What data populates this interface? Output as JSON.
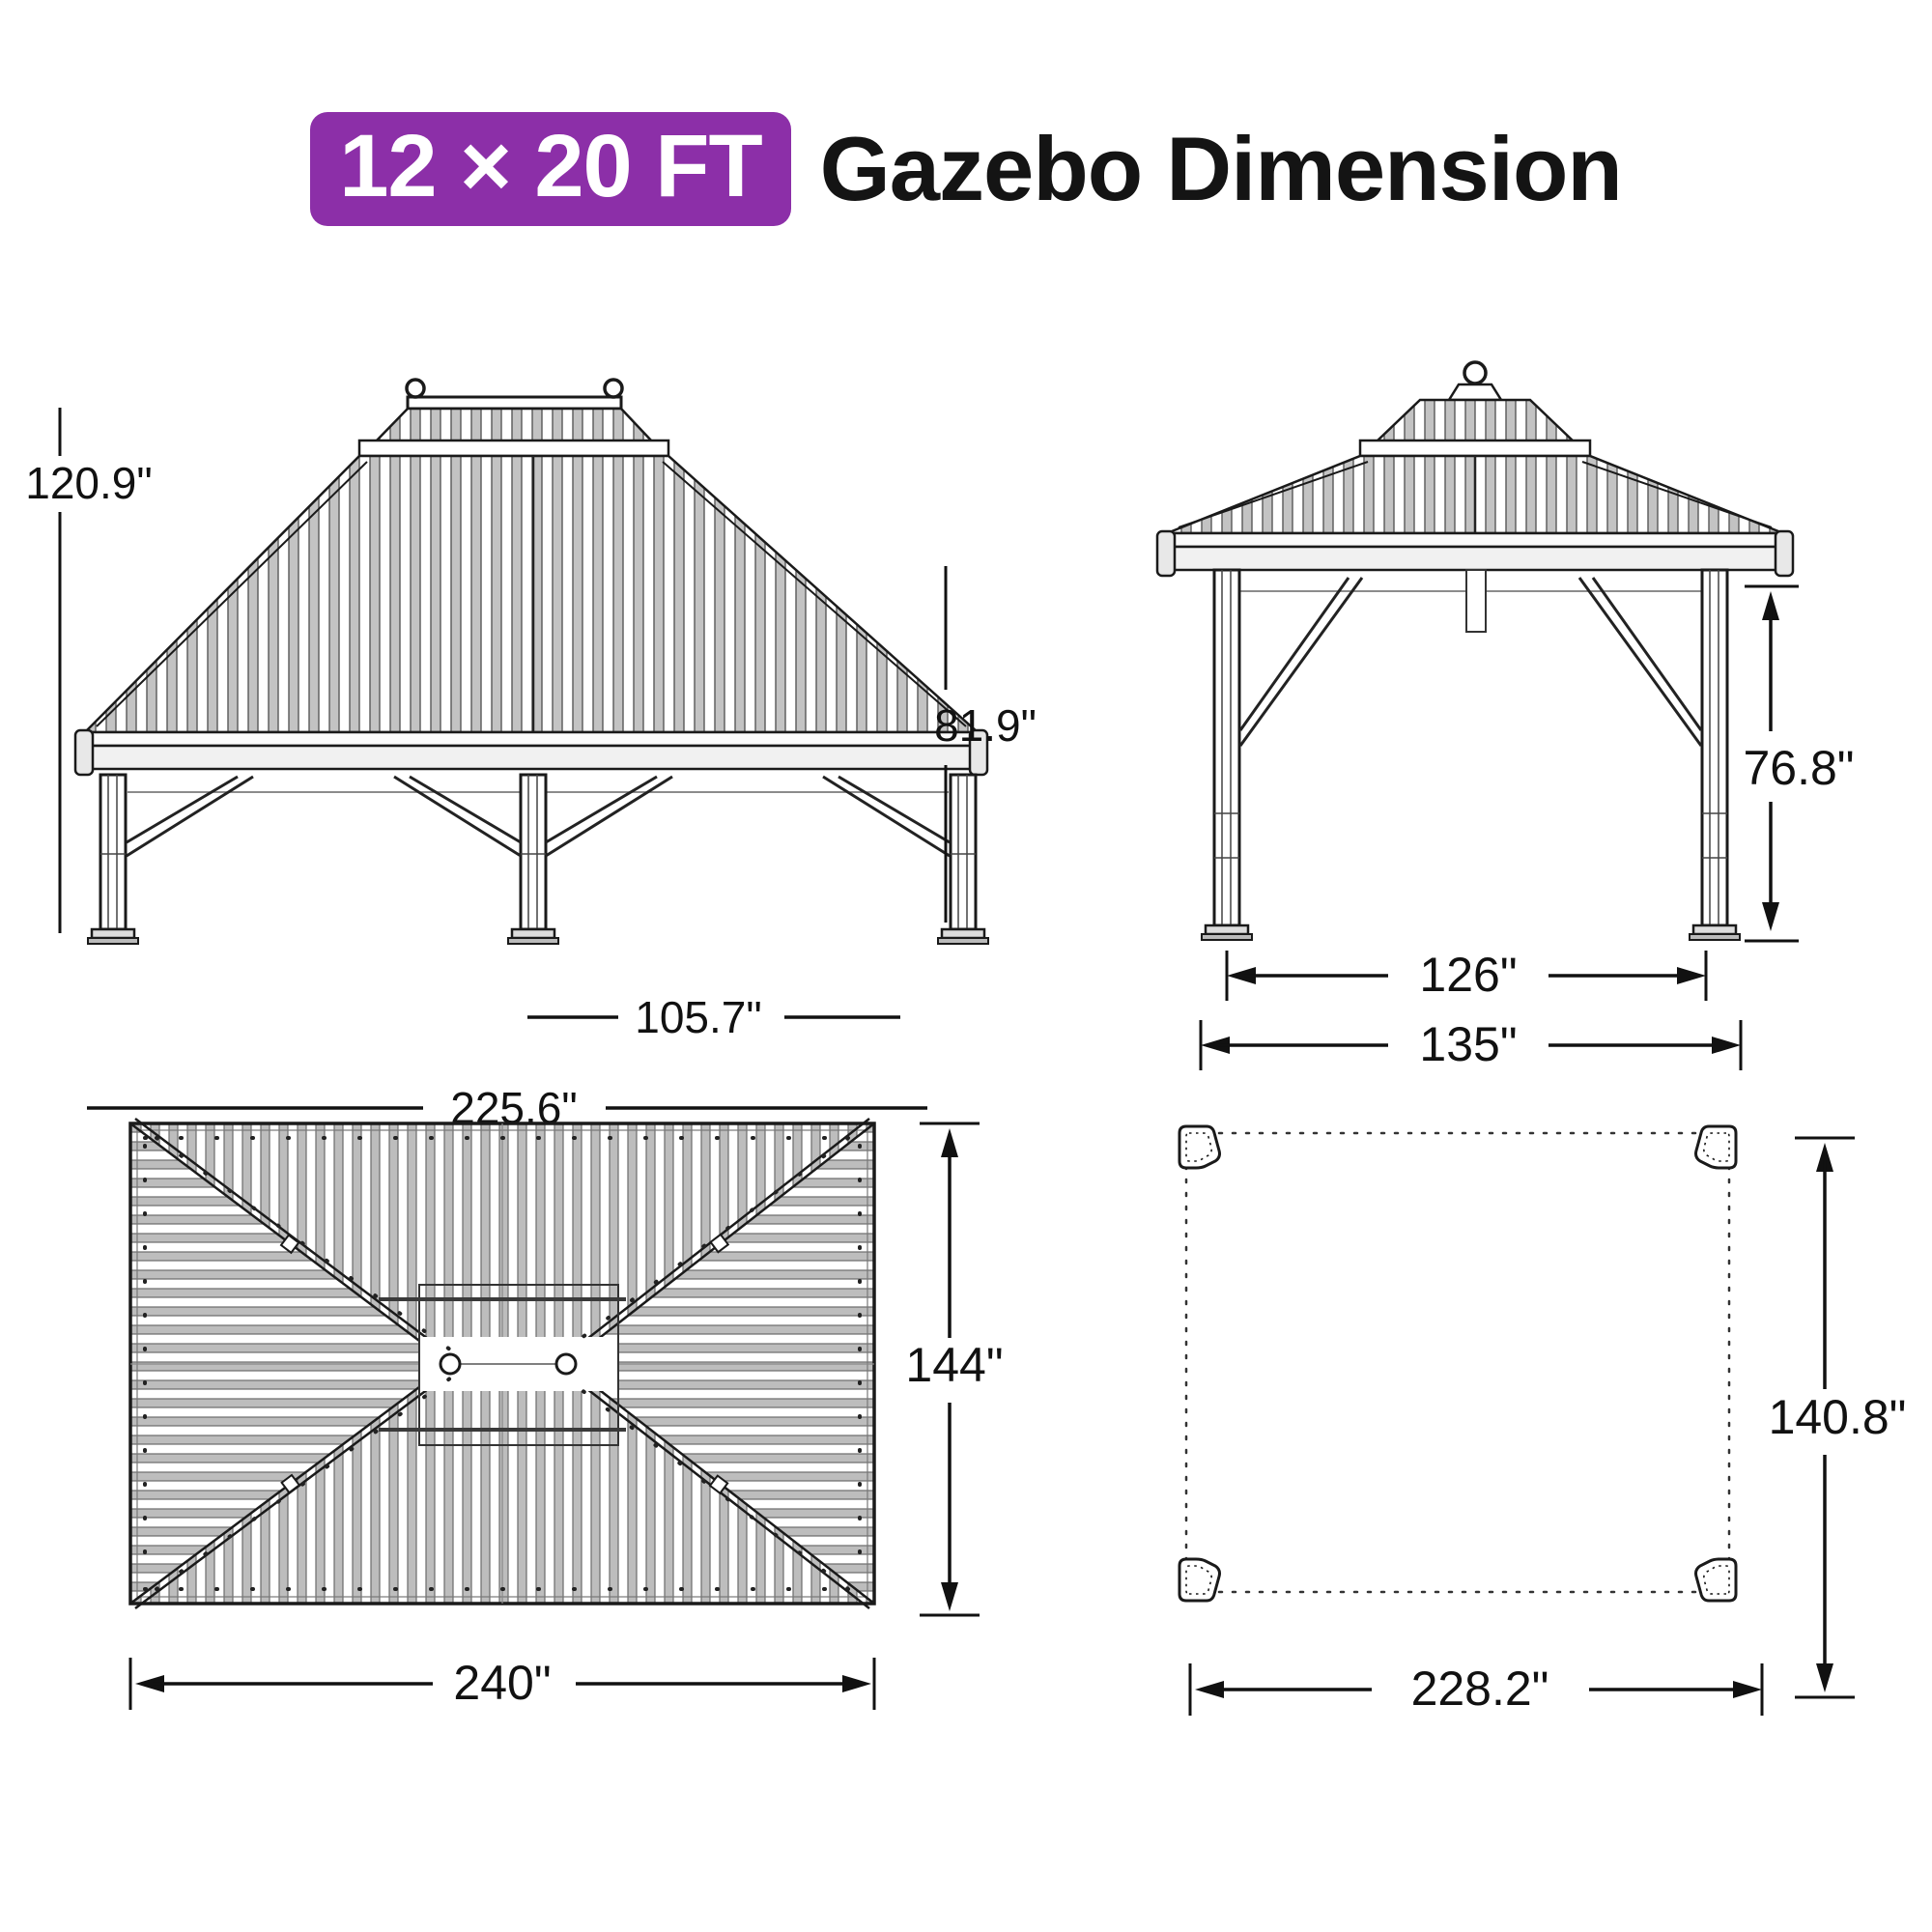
{
  "title": {
    "badge": "12 × 20 FT",
    "text": "Gazebo Dimension",
    "badge_color": "#8c2fa8"
  },
  "views": {
    "front_elevation": {
      "labels": {
        "total_height": "120.9\"",
        "post_height": "81.9\"",
        "post_spacing": "105.7\"",
        "total_width": "225.6\""
      }
    },
    "side_elevation": {
      "labels": {
        "post_height": "76.8\"",
        "post_spacing": "126\"",
        "total_width": "135\""
      }
    },
    "roof_plan": {
      "labels": {
        "depth": "144\"",
        "width": "240\""
      }
    },
    "footprint": {
      "labels": {
        "depth": "140.8\"",
        "width": "228.2\""
      }
    }
  }
}
